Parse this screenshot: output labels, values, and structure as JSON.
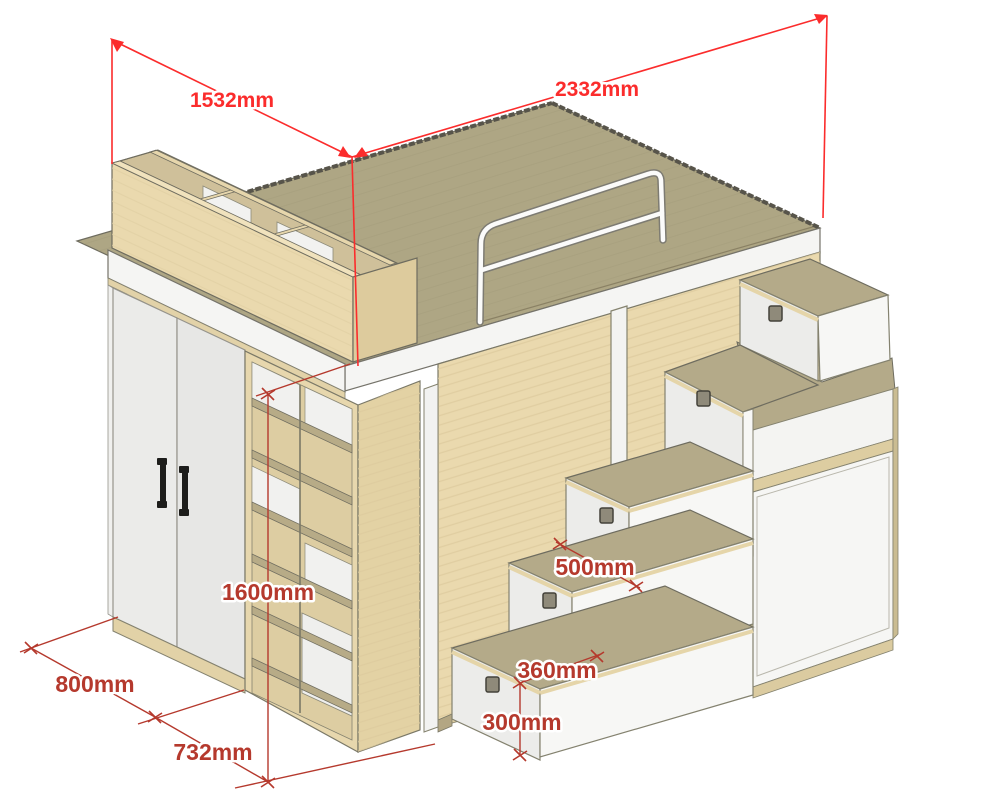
{
  "figure": {
    "subject": "Isometric drawing of a loft bed unit with wardrobe, open shelving, guard rail and storage-stair drawers",
    "units": "mm"
  },
  "dimensions": {
    "top_width": "1532mm",
    "top_length": "2332mm",
    "height": "1600mm",
    "wardrobe_depth": "800mm",
    "shelving_width": "732mm",
    "stair_tread": "500mm",
    "stair_depth": "360mm",
    "stair_height": "300mm"
  },
  "colors": {
    "dim_bright": "#fb2c2c",
    "dim_dark": "#b5392d",
    "bed_top": "#aea684",
    "wood_light": "#ead9ae",
    "wood_mid": "#d8c697",
    "panel_white": "#f4f4f2",
    "handle_black": "#1d1d1b"
  }
}
